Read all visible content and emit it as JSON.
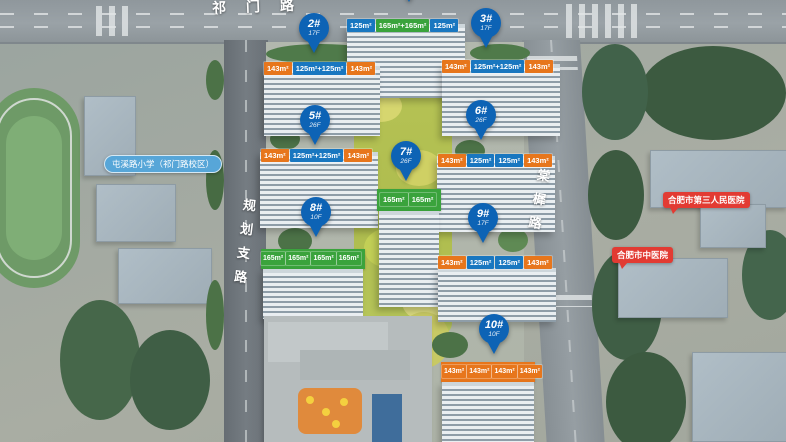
{
  "scene_title": "residential-development-aerial-site-plan",
  "roads": {
    "top": "祁门路",
    "left": "规划支路",
    "right": "棠樨路"
  },
  "poi_labels": {
    "school": "屯溪路小学（祁门路校区）",
    "hospital_1": "合肥市第三人民医院",
    "hospital_2": "合肥市中医院"
  },
  "buildings": [
    {
      "id": "1#",
      "floors": "",
      "tags": [
        {
          "t": "125m²",
          "c": "blue"
        },
        {
          "t": "165m²+165m²",
          "c": "green"
        },
        {
          "t": "125m²",
          "c": "blue"
        }
      ]
    },
    {
      "id": "2#",
      "floors": "17F",
      "tags": [
        {
          "t": "143m²",
          "c": "orange"
        },
        {
          "t": "125m²+125m²",
          "c": "blue"
        },
        {
          "t": "143m²",
          "c": "orange"
        }
      ]
    },
    {
      "id": "3#",
      "floors": "17F",
      "tags": [
        {
          "t": "143m²",
          "c": "orange"
        },
        {
          "t": "125m²+125m²",
          "c": "blue"
        },
        {
          "t": "143m²",
          "c": "orange"
        }
      ]
    },
    {
      "id": "5#",
      "floors": "26F",
      "tags": [
        {
          "t": "143m²",
          "c": "orange"
        },
        {
          "t": "125m²+125m²",
          "c": "blue"
        },
        {
          "t": "143m²",
          "c": "orange"
        }
      ]
    },
    {
      "id": "6#",
      "floors": "26F",
      "tags": [
        {
          "t": "143m²",
          "c": "orange"
        },
        {
          "t": "125m²",
          "c": "blue"
        },
        {
          "t": "125m²",
          "c": "blue"
        },
        {
          "t": "143m²",
          "c": "orange"
        }
      ]
    },
    {
      "id": "7#",
      "floors": "26F",
      "tags": [
        {
          "t": "165m²",
          "c": "green"
        },
        {
          "t": "165m²",
          "c": "green"
        }
      ]
    },
    {
      "id": "8#",
      "floors": "10F",
      "tags": [
        {
          "t": "165m²",
          "c": "green"
        },
        {
          "t": "165m²",
          "c": "green"
        },
        {
          "t": "165m²",
          "c": "green"
        },
        {
          "t": "165m²",
          "c": "green"
        }
      ]
    },
    {
      "id": "9#",
      "floors": "17F",
      "tags": [
        {
          "t": "143m²",
          "c": "orange"
        },
        {
          "t": "125m²",
          "c": "blue"
        },
        {
          "t": "125m²",
          "c": "blue"
        },
        {
          "t": "143m²",
          "c": "orange"
        }
      ]
    },
    {
      "id": "10#",
      "floors": "10F",
      "tags": [
        {
          "t": "143m²",
          "c": "orange"
        },
        {
          "t": "143m²",
          "c": "orange"
        },
        {
          "t": "143m²",
          "c": "orange"
        },
        {
          "t": "143m²",
          "c": "orange"
        }
      ]
    }
  ],
  "colors": {
    "pin_blue": "#0d63b5",
    "tag_orange": "#e7761c",
    "tag_blue": "#1977c0",
    "tag_green": "#3aa33c",
    "school_label_bg": "#57a6d8",
    "hospital_label_bg": "#e23b33"
  }
}
